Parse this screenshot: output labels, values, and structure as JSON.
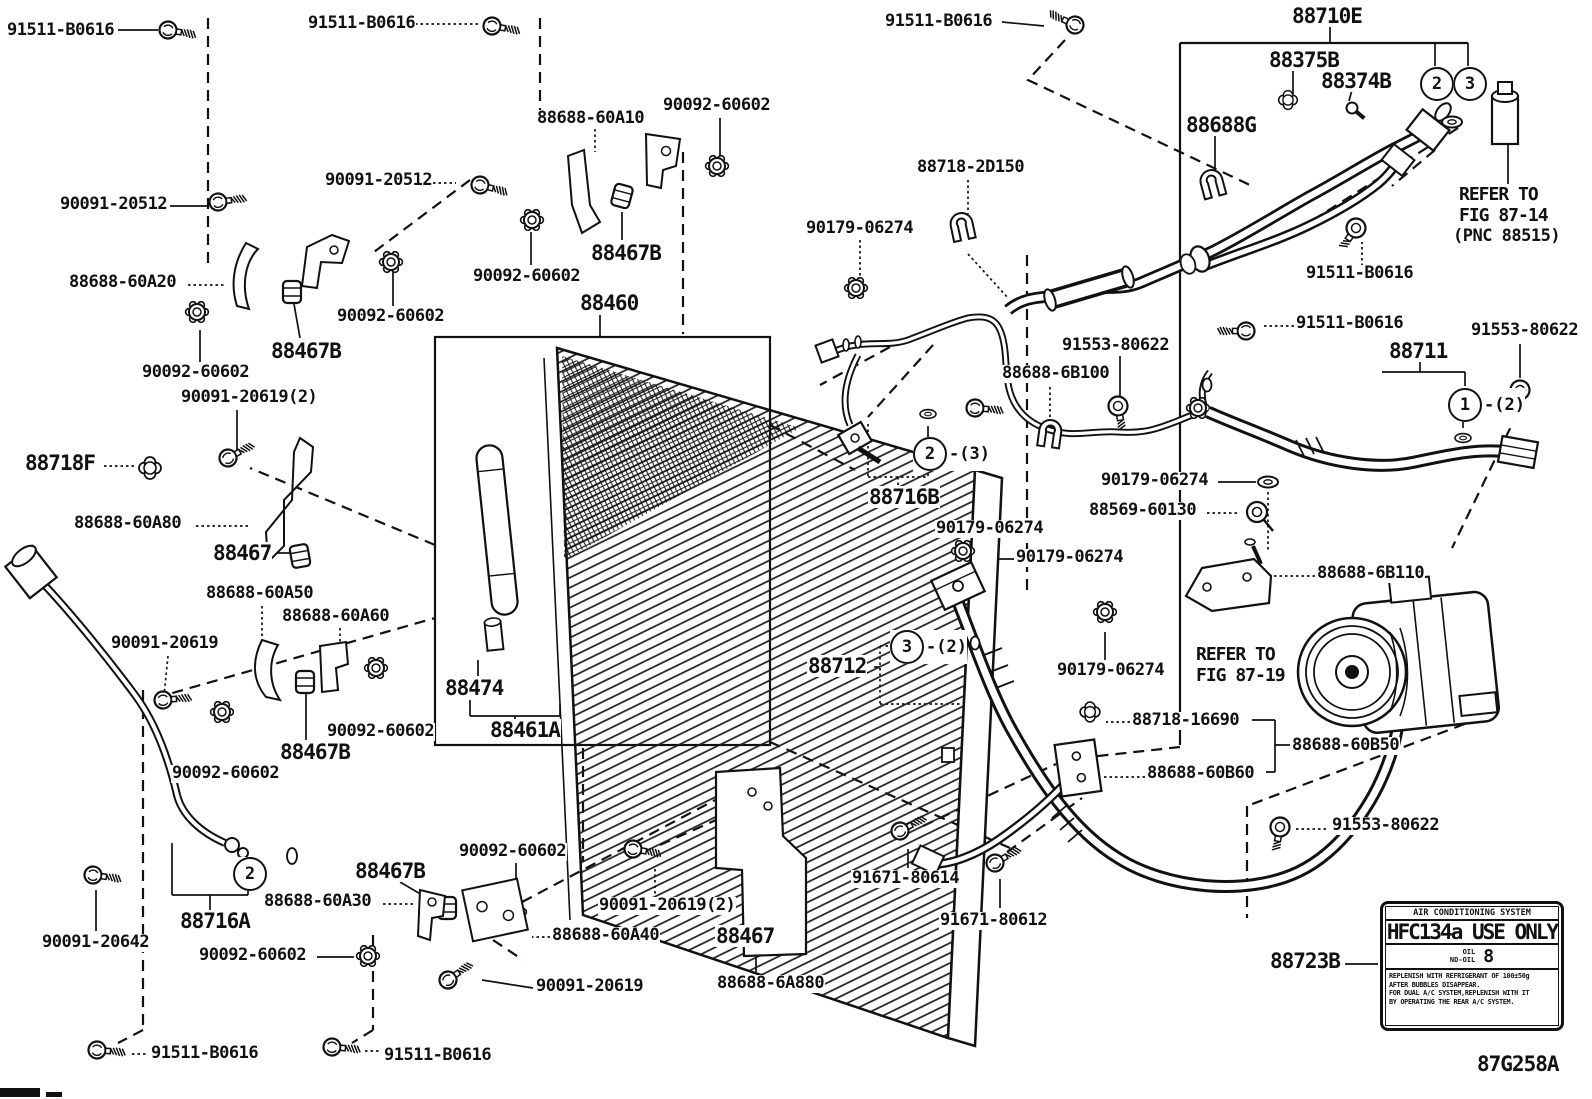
{
  "labels": [
    "91511-B0616",
    "91511-B0616",
    "91511-B0616",
    "88710E",
    "88375B",
    "88374B",
    "90092-60602",
    "88688-60A10",
    "88688G",
    "88718-2D150",
    "90091-20512",
    "90091-20512",
    "REFER TO",
    "FIG 87-14",
    "(PNC 88515)",
    "90179-06274",
    "88467B",
    "91511-B0616",
    "88688-60A20",
    "90092-60602",
    "88460",
    "90092-60602",
    "91511-B0616",
    "91553-80622",
    "88467B",
    "91553-80622",
    "88711",
    "90092-60602",
    "88688-6B100",
    "90091-20619(2)",
    "88718F",
    "90179-06274",
    "88716B",
    "88569-60130",
    "88688-60A80",
    "90179-06274",
    "88467",
    "90179-06274",
    "88688-6B110",
    "88688-60A50",
    "88688-60A60",
    "90091-20619",
    "REFER TO",
    "FIG 87-19",
    "90179-06274",
    "88474",
    "88712",
    "88461A",
    "90092-60602",
    "88718-16690",
    "88467B",
    "88688-60B50",
    "90092-60602",
    "88688-60B60",
    "91553-80622",
    "90092-60602",
    "88467B",
    "91671-80614",
    "88688-60A30",
    "90091-20619(2)",
    "88716A",
    "91671-80612",
    "88688-60A40",
    "88467",
    "90091-20642",
    "90092-60602",
    "88723B",
    "90091-20619",
    "88688-6A880",
    "91511-B0616",
    "91511-B0616",
    "87G258A"
  ],
  "callouts": [
    {
      "n": "2",
      "suffix": ""
    },
    {
      "n": "3",
      "suffix": ""
    },
    {
      "n": "1",
      "suffix": "-(2)"
    },
    {
      "n": "2",
      "suffix": "-(3)"
    },
    {
      "n": "3",
      "suffix": "-(2)"
    },
    {
      "n": "2",
      "suffix": ""
    }
  ],
  "sticker": {
    "header": "AIR CONDITIONING SYSTEM",
    "main": "HFC134a USE ONLY",
    "oil_label_1": "OIL",
    "oil_label_2": "ND-OIL",
    "oil_value": "8",
    "note_1": "REPLENISH WITH REFRIGERANT OF 100±50g",
    "note_2": "AFTER BUBBLES DISAPPEAR.",
    "note_3": "FOR DUAL A/C SYSTEM,REPLENISH WITH IT",
    "note_4": "BY OPERATING THE REAR A/C SYSTEM."
  }
}
